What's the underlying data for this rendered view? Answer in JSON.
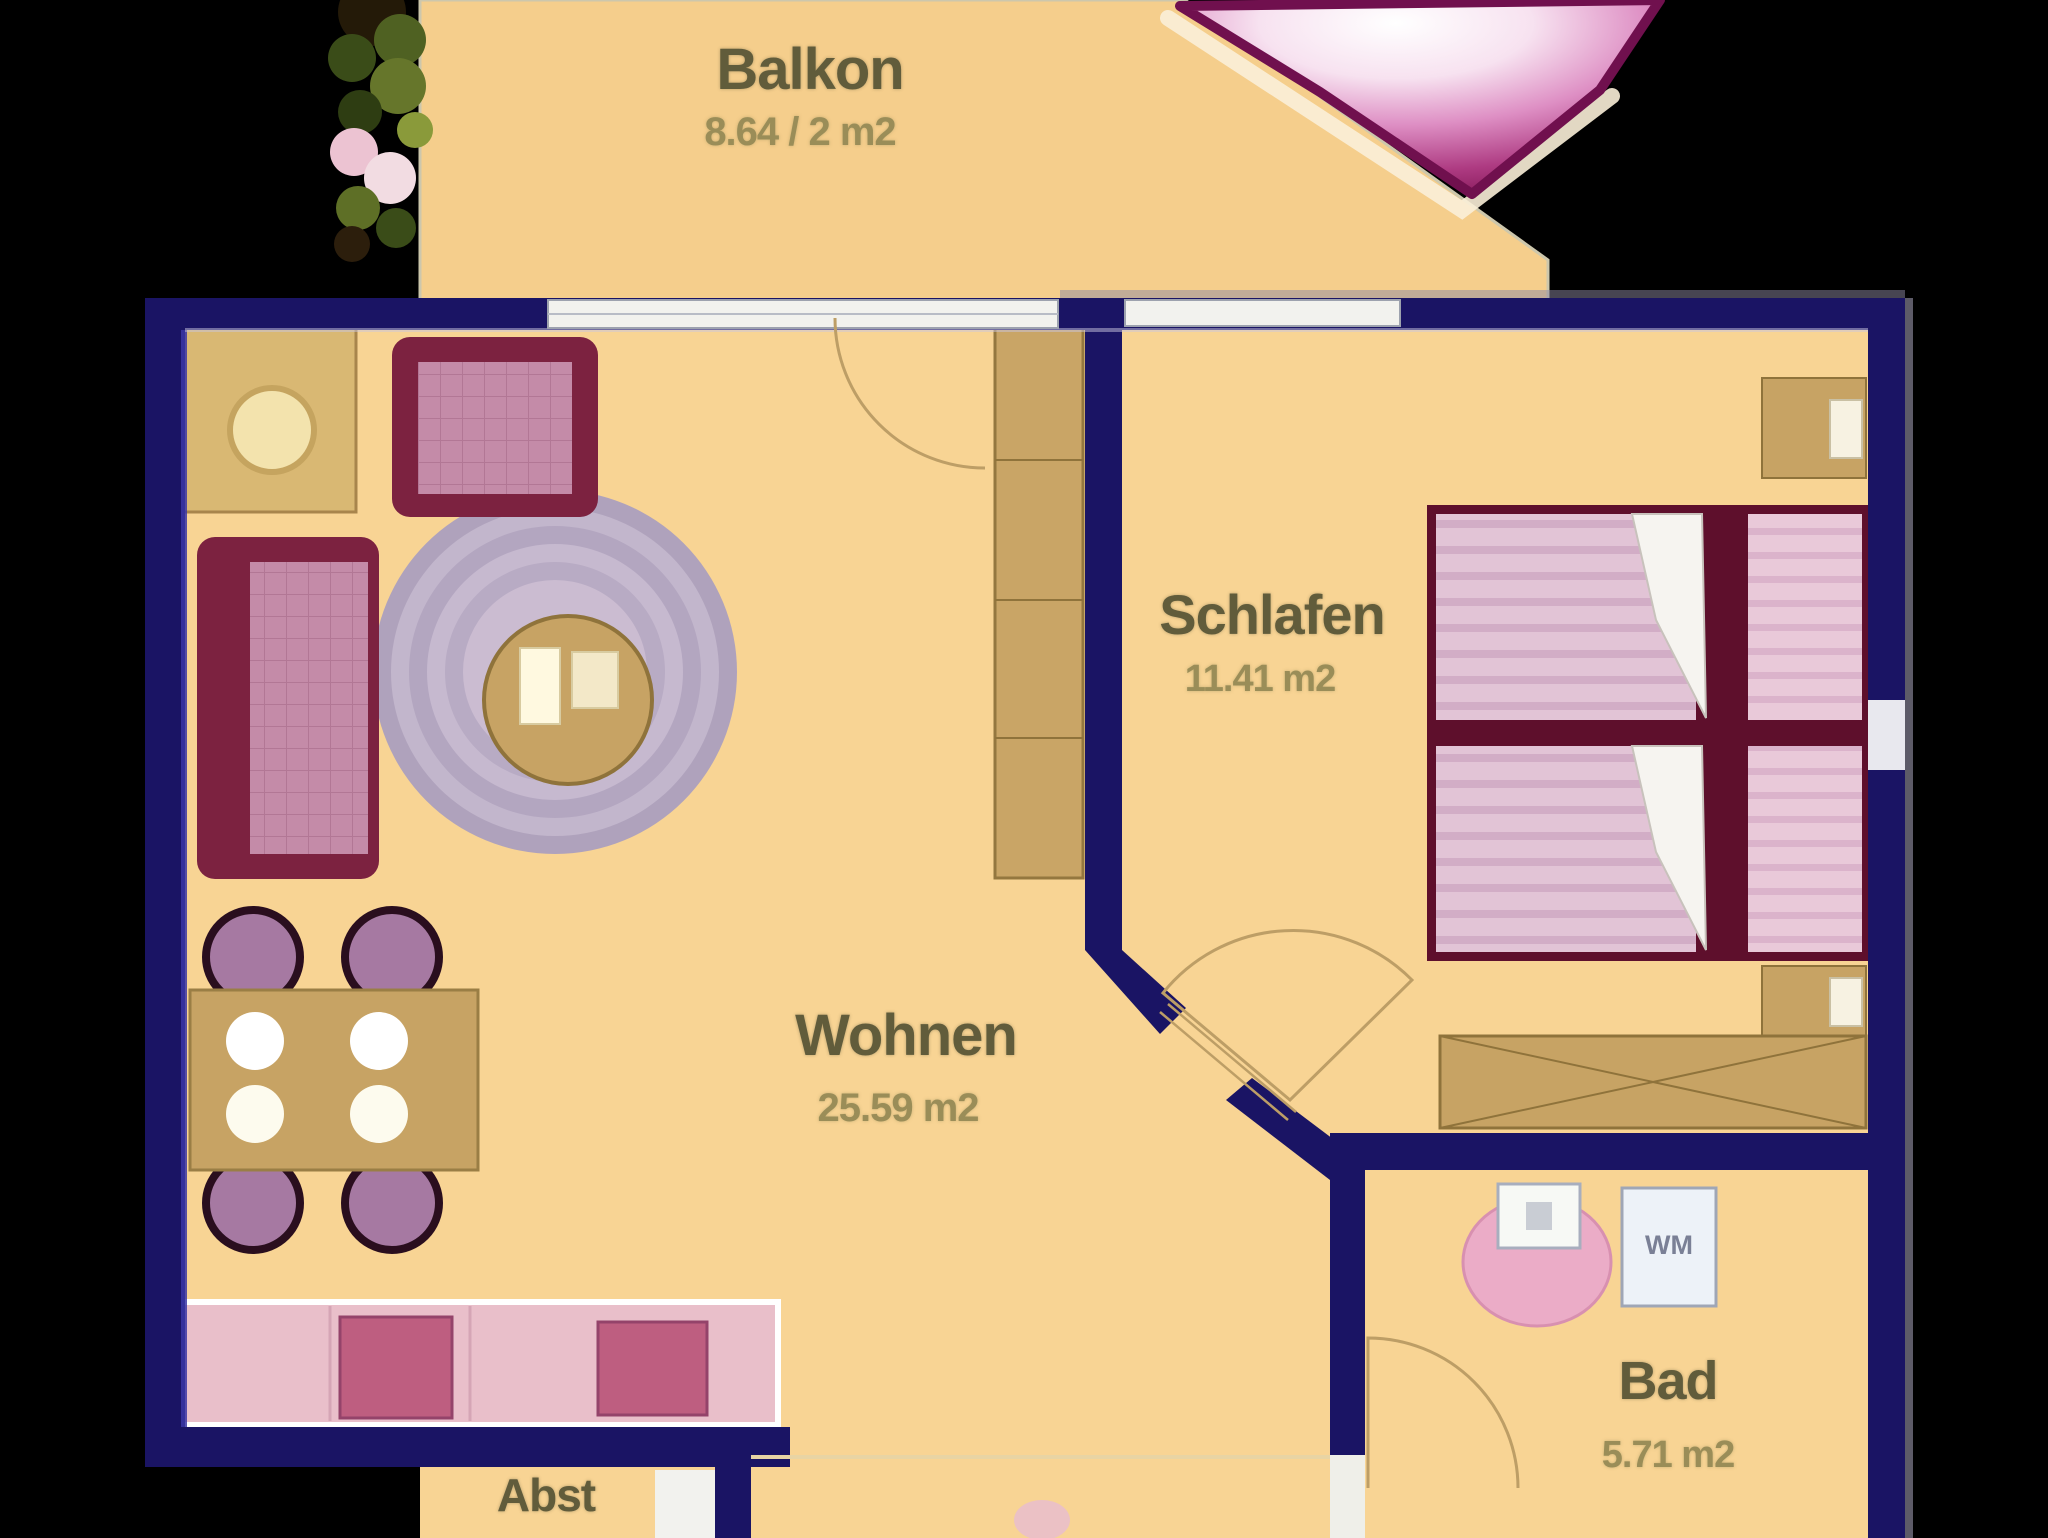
{
  "plan_title": "Apartment floor plan",
  "rooms": {
    "balkon": {
      "name": "Balkon",
      "area": "8.64 / 2 m2"
    },
    "schlafen": {
      "name": "Schlafen",
      "area": "11.41 m2"
    },
    "wohnen": {
      "name": "Wohnen",
      "area": "25.59 m2"
    },
    "bad": {
      "name": "Bad",
      "area": "5.71 m2"
    },
    "abst": {
      "name": "Abst"
    }
  },
  "appliances": {
    "washing_machine": "WM"
  },
  "colors": {
    "background": "#000000",
    "floor": "#F8D494",
    "balcony_floor": "#F5CE8C",
    "wall": "#1A1464",
    "wall_highlight": "#3B36A6",
    "furniture_tan": "#C7A364",
    "furniture_pink": "#C48BA8",
    "furniture_maroon": "#7C2240",
    "bed_pink": "#E2C4D6",
    "counter_pink": "#E9BFCA",
    "gem_magenta": "#9A2066",
    "label_olive": "#615C3B"
  }
}
